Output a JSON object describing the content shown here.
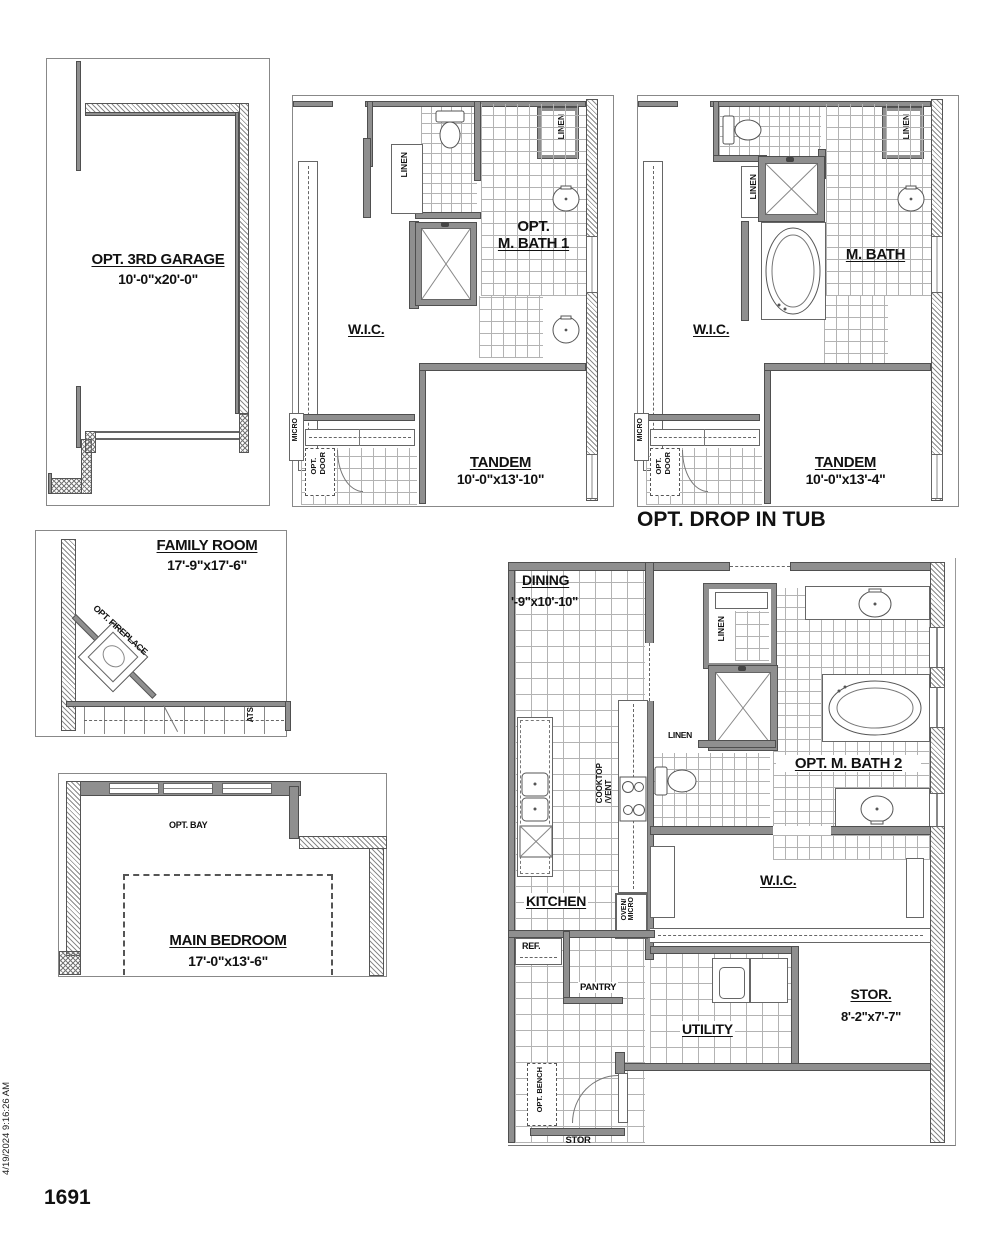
{
  "footer": {
    "plan_number": "1691",
    "timestamp": "4/19/2024 9:16:26 AM"
  },
  "garage": {
    "title": "OPT. 3RD GARAGE",
    "dims": "10'-0\"x20'-0\""
  },
  "bath1": {
    "title_line1": "OPT.",
    "title_line2": "M. BATH 1",
    "wic": "W.I.C.",
    "linen_left": "LINEN",
    "linen_right": "LINEN",
    "tandem": "TANDEM",
    "tandem_dims": "10'-0\"x13'-10\"",
    "micro": "MICRO",
    "opt_door_1": "OPT.",
    "opt_door_2": "DOOR"
  },
  "bath2": {
    "title": "M. BATH",
    "caption": "OPT. DROP IN TUB",
    "wic": "W.I.C.",
    "linen_left": "LINEN",
    "linen_right": "LINEN",
    "tandem": "TANDEM",
    "tandem_dims": "10'-0\"x13'-4\"",
    "micro": "MICRO",
    "opt_door_1": "OPT.",
    "opt_door_2": "DOOR"
  },
  "family": {
    "title": "FAMILY ROOM",
    "dims": "17'-9\"x17'-6\"",
    "fireplace": "OPT. FIREPLACE",
    "stairs": "ATS"
  },
  "bedroom": {
    "title": "MAIN BEDROOM",
    "dims": "17'-0\"x13'-6\"",
    "bay": "OPT. BAY"
  },
  "main": {
    "dining": "DINING",
    "dining_dims": "'-9\"x10'-10\"",
    "linen_closet": "LINEN",
    "linen_hall": "LINEN",
    "kitchen": "KITCHEN",
    "cooktop_1": "COOKTOP",
    "cooktop_2": "/VENT",
    "oven_1": "OVEN/",
    "oven_2": "MICRO",
    "ref": "REF.",
    "pantry": "PANTRY",
    "mbath": "OPT. M. BATH 2",
    "wic": "W.I.C.",
    "utility": "UTILITY",
    "stor": "STOR.",
    "stor_dims": "8'-2\"x7'-7\"",
    "opt_bench": "OPT. BENCH",
    "stor_small": "STOR"
  }
}
